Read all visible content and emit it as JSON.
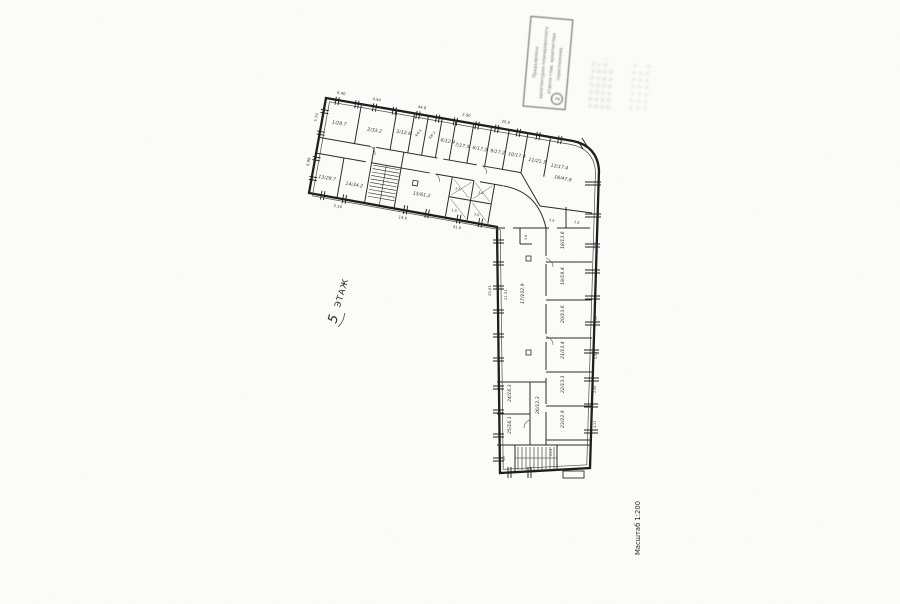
{
  "page": {
    "background": "#fdfdfc",
    "line_color": "#222222"
  },
  "labels": {
    "floor_number": "5",
    "floor_word": "ЭТАЖ",
    "scale": "Масштаб 1:200"
  },
  "stamp": {
    "lines": [
      "Предъявлено",
      "архитектурно-планировочного",
      "отдела глав. архитектора",
      "горисполкома"
    ],
    "circle_mark": "2"
  },
  "plan": {
    "top_wing": {
      "rooms_top": [
        "1/28.7",
        "2/33.2",
        "3/12.8",
        "4/6.5",
        "5/6.3",
        "6/12.4",
        "7/17.5",
        "8/17.3",
        "9/17.2",
        "10/17.4",
        "11/21.3",
        "12/17.4"
      ],
      "rooms_bottom": [
        "13/29.7",
        "14/34.2",
        "15/61.2"
      ],
      "wc_cells": [
        "2.1",
        "1.8",
        "3.4",
        "2.6"
      ],
      "dims_top": [
        "6.40",
        "4.44",
        "44.8",
        "2.90",
        "25.6"
      ],
      "dims_bottom": [
        "5.16",
        "14.6",
        "41.6"
      ],
      "dims_left": [
        "5.74",
        "6.98"
      ]
    },
    "corner": {
      "room": "16/47.8",
      "sub_labels": [
        "3.6",
        "2.8"
      ]
    },
    "vertical_wing": {
      "hall_label": "17/102.9",
      "hall_dim": "21.51",
      "notch_label": "3.6",
      "left_dim": "25.61",
      "rooms_right": [
        "18/13.6",
        "19/19.4",
        "20/13.6",
        "21/13.4",
        "22/13.1",
        "23/22.9"
      ],
      "dims_right": [
        "2.90",
        "5.16",
        "2.90",
        "2.90",
        "2.90",
        "4.21"
      ],
      "rooms_left": [
        "24/16.3",
        "25/16.1"
      ],
      "corridor_label": "26/12.3",
      "stair_cell_label": "1б",
      "bottom_dim": "21.4"
    }
  }
}
